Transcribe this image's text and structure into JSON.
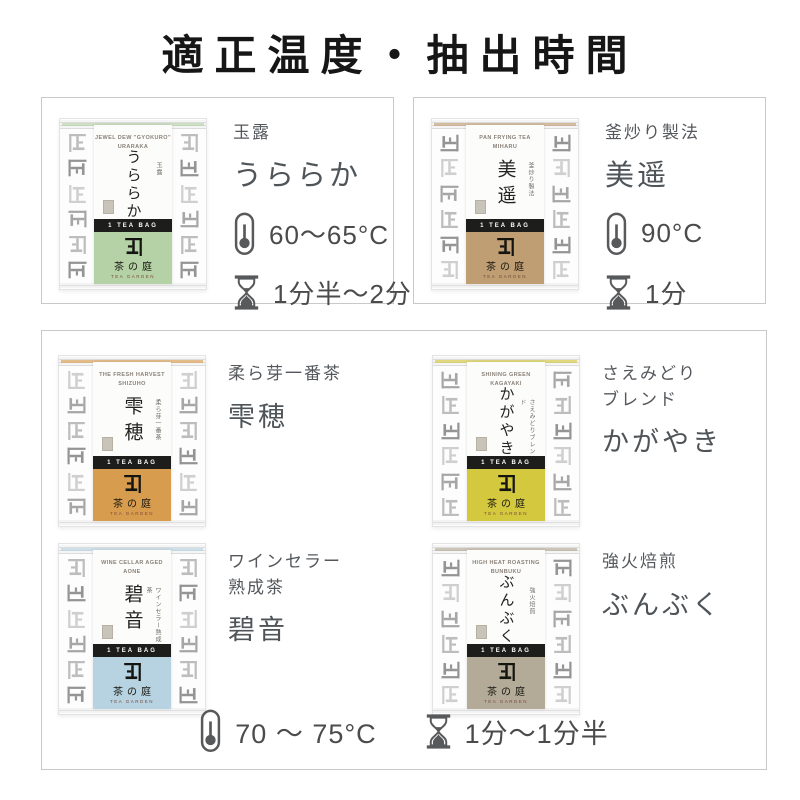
{
  "title": "適正温度・抽出時間",
  "brand": {
    "band_label": "1 TEA BAG",
    "logo_jp": "茶の庭",
    "logo_en": "TEA GARDEN"
  },
  "icons": {
    "temperature_icon": "thermometer",
    "time_icon": "hourglass",
    "brand_icon": "ue-kaneju-mark",
    "pattern_icon": "ue-mark-repeat"
  },
  "colors": {
    "card_border": "#c9c9c9",
    "title_text": "#161616",
    "label_text": "#54585c",
    "brew_text": "#4b4b4b",
    "band_black": "#1d1d1b",
    "pattern_gray": "#b0b0b0"
  },
  "products": [
    {
      "id": "uraraka",
      "label_lines": [
        "玉露"
      ],
      "name": "うららか",
      "package_en1": "JEWEL DEW \"GYOKURO\"",
      "package_en2": "URARAKA",
      "package_side": "玉露",
      "panel_color": "#b5d2a6",
      "temp": "60〜65°C",
      "time": "1分半〜2分"
    },
    {
      "id": "miharu",
      "label_lines": [
        "釜炒り製法"
      ],
      "name": "美遥",
      "package_en1": "PAN FRYING TEA",
      "package_en2": "MIHARU",
      "package_side": "釜炒り製法",
      "panel_color": "#c09e73",
      "temp": "90°C",
      "time": "1分"
    },
    {
      "id": "shizuho",
      "label_lines": [
        "柔ら芽一番茶"
      ],
      "name": "雫穂",
      "package_en1": "THE FRESH HARVEST",
      "package_en2": "SHIZUHO",
      "package_side": "柔ら芽一番茶",
      "panel_color": "#d89c4e"
    },
    {
      "id": "kagayaki",
      "label_lines": [
        "さえみどり",
        "ブレンド"
      ],
      "name": "かがやき",
      "package_en1": "SHINING GREEN",
      "package_en2": "KAGAYAKI",
      "package_side": "さえみどりブレンド",
      "panel_color": "#d3c83e"
    },
    {
      "id": "aone",
      "label_lines": [
        "ワインセラー",
        "熟成茶"
      ],
      "name": "碧音",
      "package_en1": "WINE CELLAR AGED",
      "package_en2": "AONE",
      "package_side": "ワインセラー熟成茶",
      "panel_color": "#b7d3e2"
    },
    {
      "id": "bunbuku",
      "label_lines": [
        "強火焙煎"
      ],
      "name": "ぶんぶく",
      "package_en1": "HIGH HEAT ROASTING",
      "package_en2": "BUNBUKU",
      "package_side": "強火焙煎",
      "panel_color": "#b3ab97"
    }
  ],
  "shared_brew": {
    "temp": "70 〜 75°C",
    "time": "1分〜1分半"
  }
}
